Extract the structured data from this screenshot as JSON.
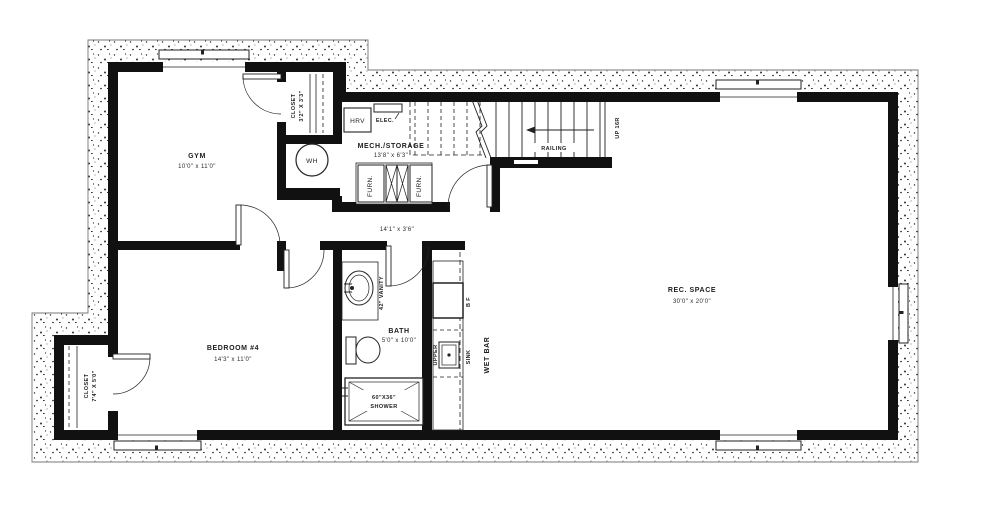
{
  "labels": {
    "gym_name": "GYM",
    "gym_dims": "10'0\" x 11'0\"",
    "gym_closet_name": "CLOSET",
    "gym_closet_dims": "3'2\" X 3'3\"",
    "wh": "WH",
    "hrv": "HRV",
    "elec": "ELEC.",
    "mech_name": "MECH./STORAGE",
    "mech_dims": "13'8\" x 6'3\"",
    "furn_left": "FURN.",
    "furn_right": "FURN.",
    "railing": "RAILING",
    "up": "UP 16R",
    "hall_dims": "14'1\" x 3'6\"",
    "bedroom_name": "BEDROOM #4",
    "bedroom_dims": "14'3\" x 11'0\"",
    "bedroom_closet_name": "CLOSET",
    "bedroom_closet_dims": "7'4\" X 5'0\"",
    "vanity": "42\" VANITY",
    "bath_name": "BATH",
    "bath_dims": "5'0\" x 10'0\"",
    "shower_size": "60\"X36\"",
    "shower_name": "SHOWER",
    "bar_fridge": "B F",
    "upper": "UPPER",
    "sink": "SINK",
    "wet_bar": "WET BAR",
    "rec_name": "REC. SPACE",
    "rec_dims": "30'0\" x 20'0\""
  },
  "colors": {
    "wall": "#111111",
    "paper": "#ffffff",
    "ink": "#1c1c1c"
  }
}
